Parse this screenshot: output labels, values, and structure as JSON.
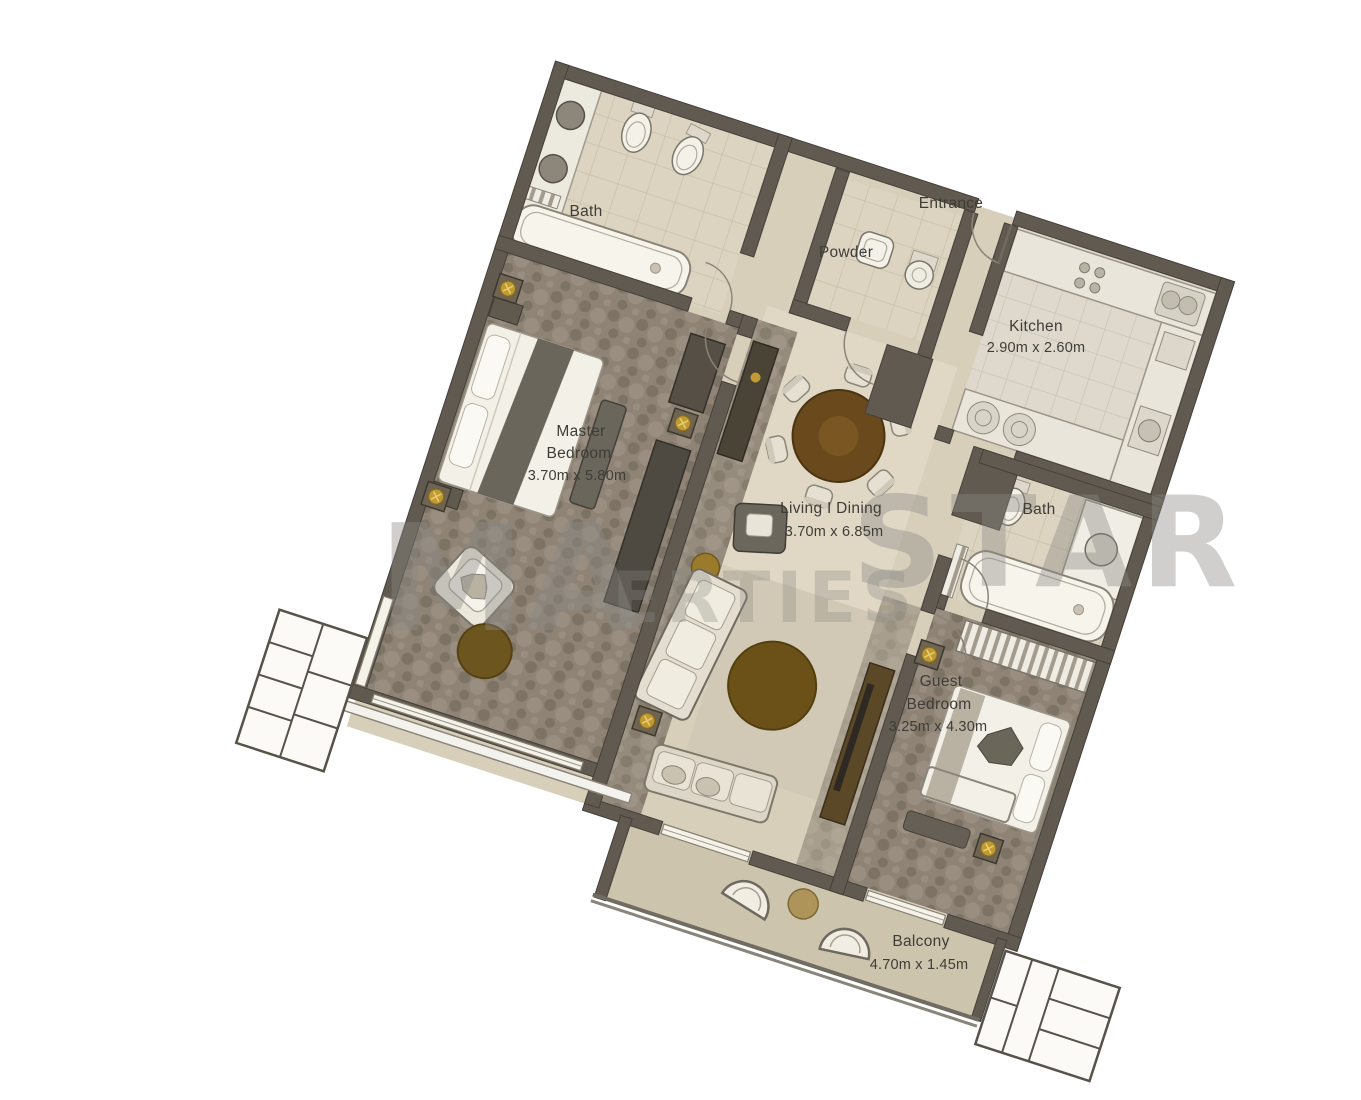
{
  "rooms": {
    "master_bath": {
      "label": "Bath"
    },
    "powder": {
      "label": "Powder"
    },
    "entrance": {
      "label": "Entrance"
    },
    "kitchen": {
      "label": "Kitchen",
      "dims": "2.90m x 2.60m"
    },
    "master_bedroom": {
      "label_line1": "Master",
      "label_line2": "Bedroom",
      "dims": "3.70m x 5.80m"
    },
    "living_dining": {
      "label": "Living I Dining",
      "dims": "3.70m x 6.85m"
    },
    "guest_bath": {
      "label": "Bath"
    },
    "guest_bedroom": {
      "label_line1": "Guest",
      "label_line2": "Bedroom",
      "dims": "3.25m x 4.30m"
    },
    "balcony": {
      "label": "Balcony",
      "dims": "4.70m x 1.45m"
    }
  },
  "watermark": {
    "fragment_left": "MA",
    "fragment_right": "STAR",
    "fragment_bottom": "ERTIES"
  },
  "colors": {
    "wall": "#615a50",
    "floor_beige": "#d8cfbb",
    "carpet": "#8e8375",
    "wood_dark": "#6a4a1c",
    "accent_gold": "#c09a33",
    "label_text": "#3f3d38",
    "watermark_gray": "#8b8a86"
  }
}
